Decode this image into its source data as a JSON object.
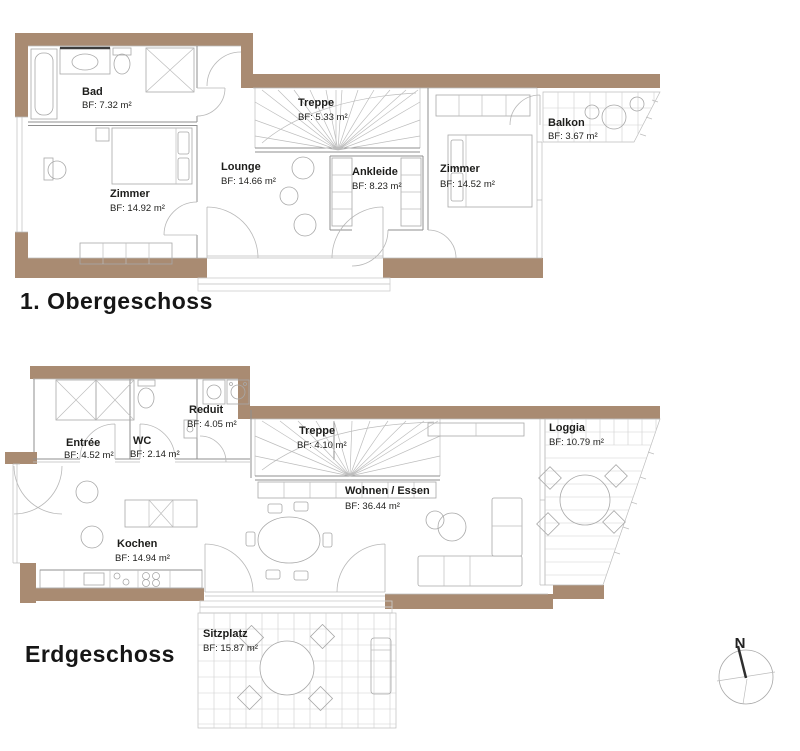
{
  "colors": {
    "wall": "#A98B72",
    "line": "#8f8f8f",
    "line_light": "#bdbdbd",
    "grid": "#cfcfcf",
    "text": "#1d1d1b",
    "background": "#ffffff"
  },
  "floors": [
    {
      "title": "1. Obergeschoss",
      "rooms": [
        {
          "name": "Bad",
          "area": "BF: 7.32 m²"
        },
        {
          "name": "Zimmer",
          "area": "BF: 14.92 m²"
        },
        {
          "name": "Lounge",
          "area": "BF: 14.66 m²"
        },
        {
          "name": "Treppe",
          "area": "BF: 5.33 m²"
        },
        {
          "name": "Ankleide",
          "area": "BF: 8.23 m²"
        },
        {
          "name": "Zimmer",
          "area": "BF: 14.52 m²"
        },
        {
          "name": "Balkon",
          "area": "BF: 3.67 m²"
        }
      ]
    },
    {
      "title": "Erdgeschoss",
      "rooms": [
        {
          "name": "Entrée",
          "area": "BF: 4.52 m²"
        },
        {
          "name": "WC",
          "area": "BF: 2.14 m²"
        },
        {
          "name": "Reduit",
          "area": "BF: 4.05 m²"
        },
        {
          "name": "Treppe",
          "area": "BF: 4.10 m²"
        },
        {
          "name": "Kochen",
          "area": "BF: 14.94 m²"
        },
        {
          "name": "Wohnen / Essen",
          "area": "BF: 36.44 m²"
        },
        {
          "name": "Loggia",
          "area": "BF: 10.79 m²"
        },
        {
          "name": "Sitzplatz",
          "area": "BF: 15.87 m²"
        }
      ]
    }
  ],
  "compass": {
    "north_label": "N"
  }
}
